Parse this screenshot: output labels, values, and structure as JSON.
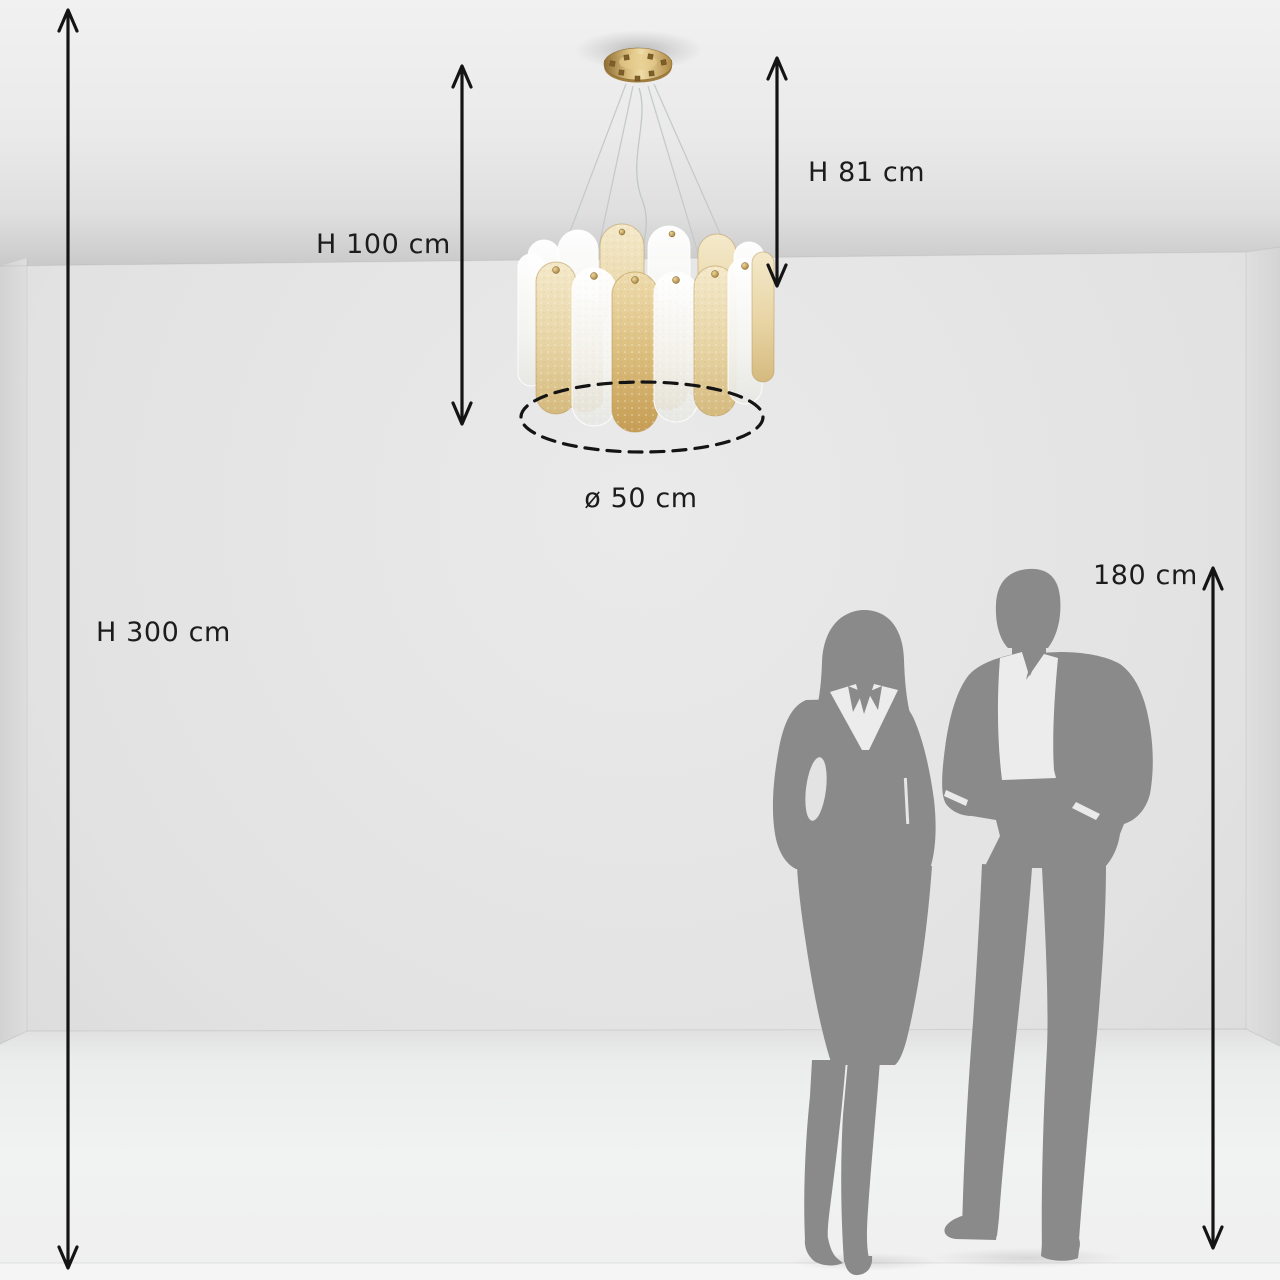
{
  "diagram": {
    "labels": {
      "room_height": "H 300 cm",
      "fixture_height": "H 100 cm",
      "suspension_height": "H 81 cm",
      "diameter": "ø 50 cm",
      "person_height": "180 cm"
    },
    "values_cm": {
      "room_height": 300,
      "fixture_height": 100,
      "suspension_height": 81,
      "diameter": 50,
      "person_height": 180
    },
    "colors": {
      "dimension_lines": "#141414",
      "label_text": "#1c1c1c",
      "silhouettes": "#8a8a8a",
      "brass_gold": "#c9a55e",
      "wall": "#e2e2e2",
      "floor": "#f1f2f2"
    }
  }
}
